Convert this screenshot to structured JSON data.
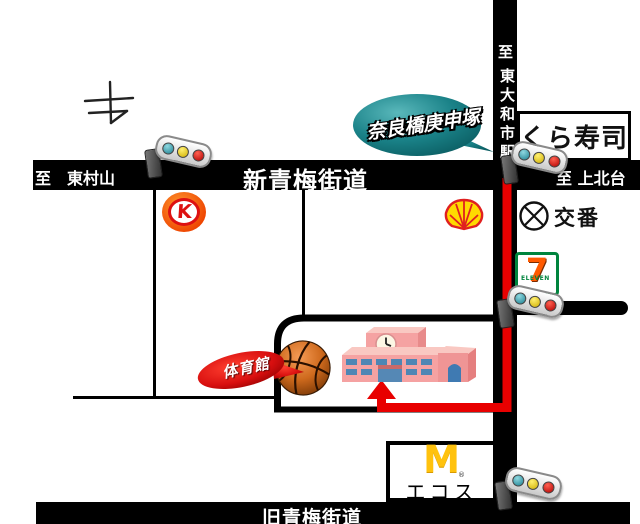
{
  "roads": {
    "shin_oume_label": "新青梅街道",
    "dest_higashimurayama": "至　東村山",
    "dest_kamikitadai": "至 上北台",
    "dest_to": "至",
    "dest_station": "東大和市駅",
    "kyu_oume_label": "旧青梅街道"
  },
  "bubble": {
    "label": "奈良橋庚申塚",
    "color": "#15787e"
  },
  "gym_banner": {
    "label": "体育館",
    "color": "#cc0000"
  },
  "landmarks": {
    "kura_sushi": "くら寿司",
    "koban": "交番",
    "circle_k_letter": "K",
    "seven_digit": "7",
    "seven_word": "ELEVEN",
    "mcd_letter": "M",
    "mcd_reg": "®",
    "ecos": "エコス"
  },
  "route": {
    "color": "#e80000"
  }
}
